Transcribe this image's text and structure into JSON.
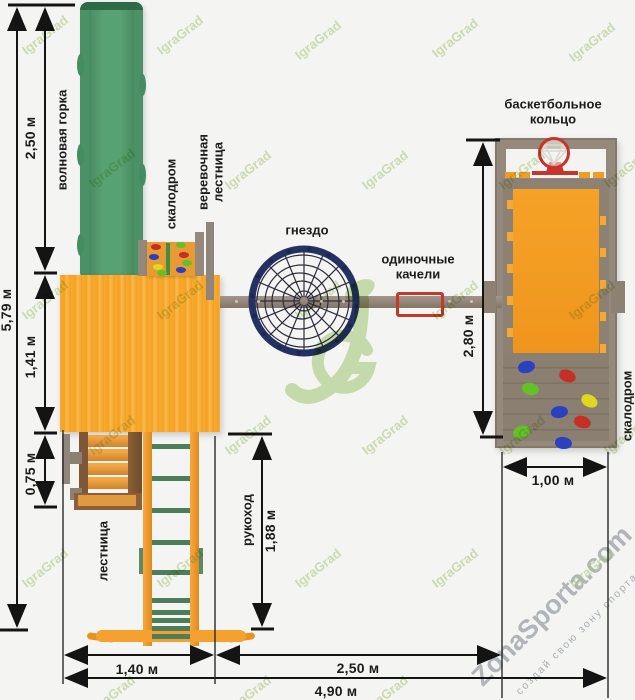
{
  "labels": {
    "wave_slide": "волновая горка",
    "climbing_wall_left": "скалодром",
    "rope_ladder": "веревочная лестница",
    "nest": "гнездо",
    "single_swing": "одиночные качели",
    "basketball_ring": "баскетбольное кольцо",
    "climbing_wall_right": "скалодром",
    "stairs": "лестница",
    "monkey_bars": "рукоход"
  },
  "dimensions": {
    "total_height": "5,79 м",
    "slide_projection": "2,50 м",
    "platform_depth": "1,41 м",
    "stairs_depth": "0,75 м",
    "monkey_bars_length": "1,88 м",
    "tower_depth": "2,80 м",
    "tower_width": "1,00 м",
    "base_width": "1,40 м",
    "swing_span": "2,50 м",
    "total_width": "4,90 м"
  },
  "watermarks": {
    "brand": "IgraGrad",
    "logo_initials": "JG",
    "site": "ZonaSporta.com",
    "site_tagline": "создай свою зону спорта"
  },
  "colors": {
    "background": "#f4f4f2",
    "slide_green": "#4b9166",
    "platform_orange": "#f6a82b",
    "wood_gray": "#95897b",
    "nest_navy": "#243263",
    "hoop_red": "#c7342b",
    "swing_red": "#c23a2b",
    "hold_red": "#c62f23",
    "hold_blue": "#2b41c0",
    "hold_green": "#64c027",
    "hold_yellow": "#e0d71f",
    "dimension_black": "#141414",
    "watermark_green": "#afd07d"
  }
}
